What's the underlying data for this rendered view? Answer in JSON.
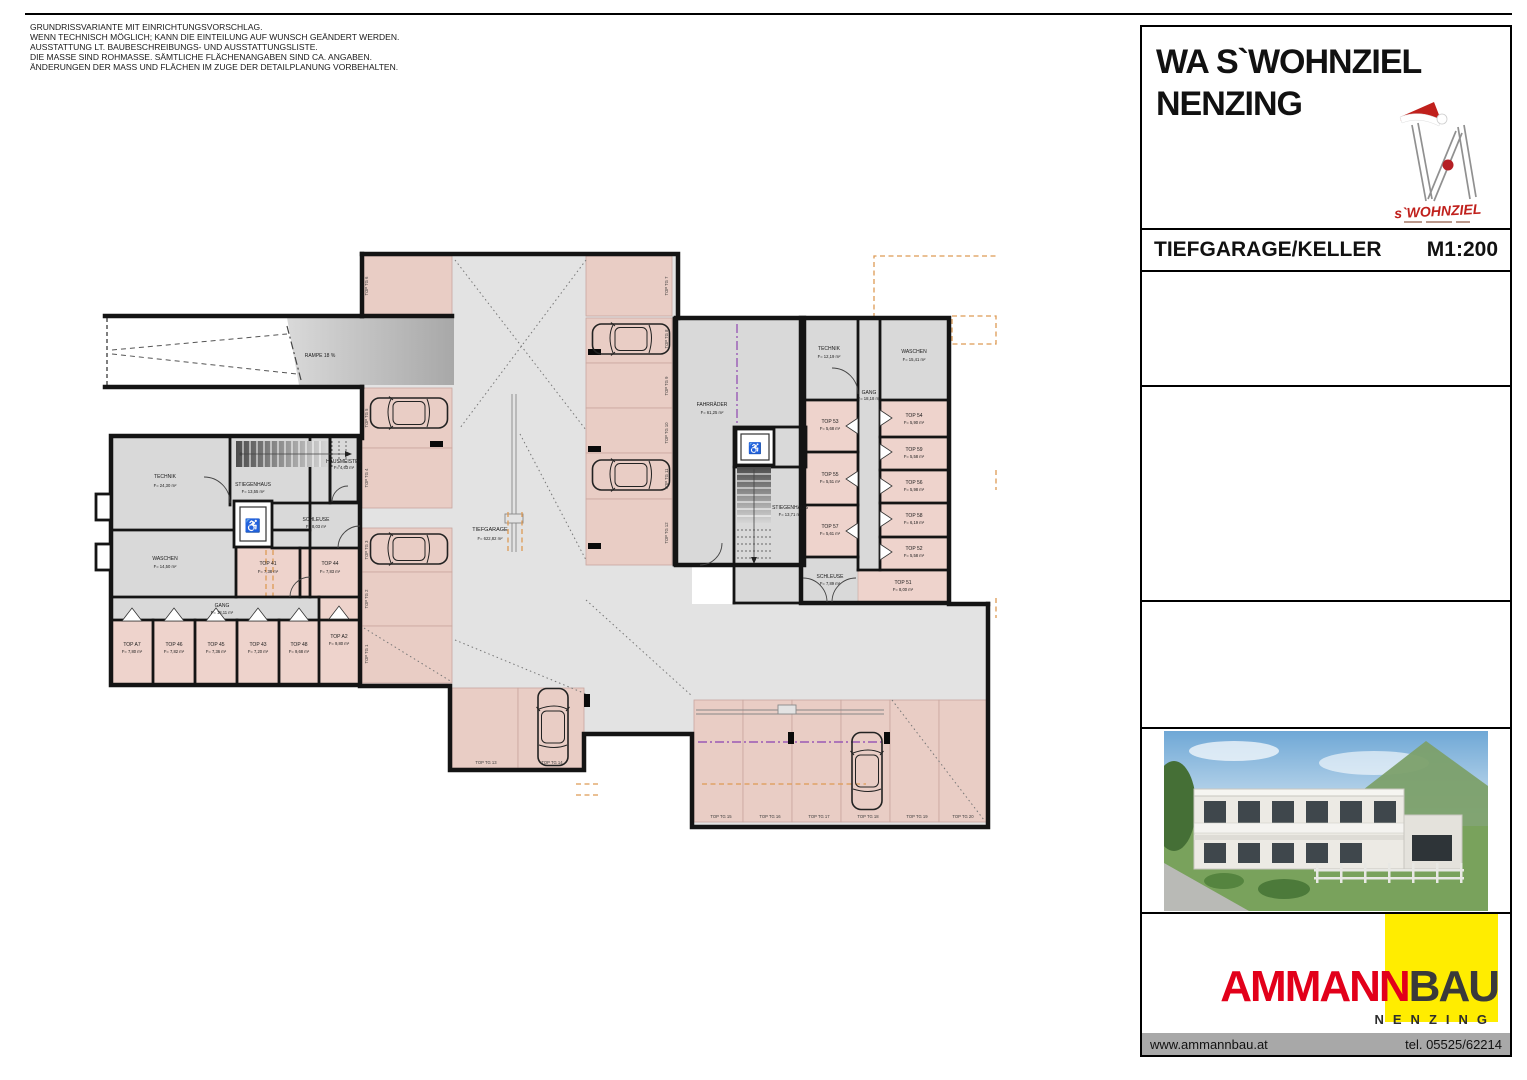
{
  "disclaimer": {
    "lines": [
      "GRUNDRISSVARIANTE MIT EINRICHTUNGSVORSCHLAG.",
      "WENN TECHNISCH MÖGLICH; KANN DIE EINTEILUNG AUF WUNSCH GEÄNDERT WERDEN.",
      "AUSSTATTUNG LT. BAUBESCHREIBUNGS- UND AUSSTATTUNGSLISTE.",
      "DIE MASSE SIND ROHMASSE. SÄMTLICHE FLÄCHENANGABEN SIND CA. ANGABEN.",
      "ÄNDERUNGEN DER MASS UND FLÄCHEN IM ZUGE DER DETAILPLANUNG VORBEHALTEN."
    ]
  },
  "titleblock": {
    "project_line1": "WA S`WOHNZIEL",
    "project_line2": "NENZING",
    "logo_text": "s`WOHNZIEL",
    "drawing_title": "TIEFGARAGE/KELLER",
    "scale": "M1:200"
  },
  "footer": {
    "brand_red": "AMMANN",
    "brand_dark": "BAU",
    "brand_city": "NENZING",
    "website": "www.ammannbau.at",
    "phone": "tel. 05525/62214"
  },
  "icons": {
    "wheelchair": "♿"
  },
  "colors": {
    "brand_red": "#e2001a",
    "brand_yellow": "#ffed00",
    "wall": "#141414",
    "parking_pink": "#e9cdc5",
    "floor_gray": "#e3e3e3",
    "room_gray": "#d9d9d9",
    "orange_dash": "#dd9a55",
    "violet_line": "#9a5ab5"
  },
  "plan": {
    "ramp_label": "RAMPE 18 %",
    "tiefgarage": {
      "name": "TIEFGARAGE",
      "area": "F= 622,82 m²"
    },
    "rooms": {
      "technik_l": {
        "name": "TECHNIK",
        "area": "F= 24,30 m²"
      },
      "waschen_l": {
        "name": "WASCHEN",
        "area": "F= 14,50 m²"
      },
      "stiegenhaus_l": {
        "name": "STIEGENHAUS",
        "area": "F= 13,55 m²"
      },
      "hausmeister": {
        "name": "HAUSMEISTER",
        "area": "F= 4,63 m²"
      },
      "schleuse_l": {
        "name": "SCHLEUSE",
        "area": "F= 8,03 m²"
      },
      "gang_l": {
        "name": "GANG",
        "area": "F= 18,11 m²"
      },
      "top41": {
        "name": "TOP 41",
        "area": "F= 7,38 m²"
      },
      "top44": {
        "name": "TOP 44",
        "area": "F= 7,83 m²"
      },
      "topA7": {
        "name": "TOP A7",
        "area": "F= 7,80 m²"
      },
      "top46": {
        "name": "TOP 46",
        "area": "F= 7,82 m²"
      },
      "top45": {
        "name": "TOP 45",
        "area": "F= 7,36 m²"
      },
      "top43": {
        "name": "TOP 43",
        "area": "F= 7,20 m²"
      },
      "top48": {
        "name": "TOP 48",
        "area": "F= 9,68 m²"
      },
      "topA2": {
        "name": "TOP A2",
        "area": "F= 9,80 m²"
      },
      "fahrraeder": {
        "name": "FAHRRÄDER",
        "area": "F= 61,25 m²"
      },
      "stiegenhaus_m": {
        "name": "STIEGENHAUS",
        "area": "F= 13,71 m²"
      },
      "technik_r": {
        "name": "TECHNIK",
        "area": "F= 12,19 m²"
      },
      "waschen_r": {
        "name": "WASCHEN",
        "area": "F= 15,41 m²"
      },
      "gang_r": {
        "name": "GANG",
        "area": "F= 18,18 m²"
      },
      "top53": {
        "name": "TOP 53",
        "area": "F= 5,68 m²"
      },
      "top55": {
        "name": "TOP 55",
        "area": "F= 5,51 m²"
      },
      "top57": {
        "name": "TOP 57",
        "area": "F= 5,61 m²"
      },
      "schleuse_r": {
        "name": "SCHLEUSE",
        "area": "F= 7,89 m²"
      },
      "top54": {
        "name": "TOP 54",
        "area": "F= 5,90 m²"
      },
      "top59": {
        "name": "TOP 59",
        "area": "F= 5,58 m²"
      },
      "top56": {
        "name": "TOP 56",
        "area": "F= 5,98 m²"
      },
      "top58": {
        "name": "TOP 58",
        "area": "F= 6,19 m²"
      },
      "top52": {
        "name": "TOP 52",
        "area": "F= 5,58 m²"
      },
      "top51": {
        "name": "TOP 51",
        "area": "F= 8,00 m²"
      }
    },
    "parking": {
      "tg1": "TOP TG 1",
      "tg2": "TOP TG 2",
      "tg3": "TOP TG 3",
      "tg4": "TOP TG 4",
      "tg5": "TOP TG 5",
      "tg6": "TOP TG 6",
      "tg7": "TOP TG 7",
      "tg8": "TOP TG 8",
      "tg9": "TOP TG 9",
      "tg10": "TOP TG 10",
      "tg11": "TOP TG 11",
      "tg12": "TOP TG 12",
      "tg13": "TOP TG 13",
      "tg14": "TOP TG 14",
      "tg15": "TOP TG 15",
      "tg16": "TOP TG 16",
      "tg17": "TOP TG 17",
      "tg18": "TOP TG 18",
      "tg19": "TOP TG 19",
      "tg20": "TOP TG 20"
    }
  }
}
